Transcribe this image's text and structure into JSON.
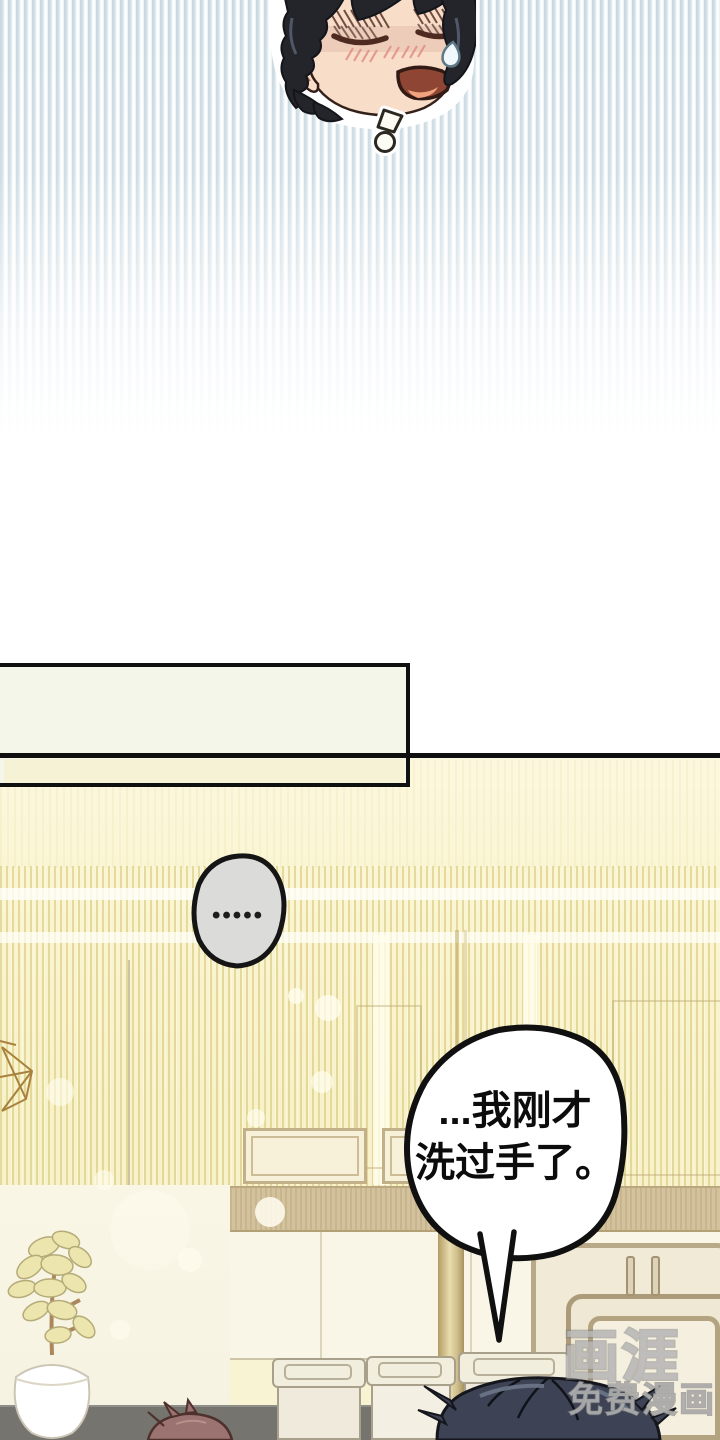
{
  "page": {
    "kind": "webtoon comic page"
  },
  "narration_box": {
    "text": ""
  },
  "thought_bubble": {
    "dots": "•••••"
  },
  "speech_bubble": {
    "line1": "...我刚才",
    "line2": "洗过手了。"
  },
  "watermark": {
    "logo": "画涯",
    "label": "免费漫画"
  },
  "colors": {
    "stripe_blue": "#c7d7e0",
    "panel_yellow": "#f8f3cc",
    "stripe_gold": "#e7d98f",
    "ink": "#111111",
    "thought_grey": "#dbdbd9",
    "speech_white": "#ffffff",
    "hair_black": "#23252b",
    "hair_navy": "#3d4354",
    "hair_mauve": "#9b7370",
    "skin": "#f8ddc9",
    "wood_tan": "#c3ae7f",
    "floor_grey": "#75746e"
  },
  "icons": {
    "sweat_drop_icon": "teardrop",
    "surprise_mark_icon": "!",
    "pendant_lamp_icon": "wireframe-diamond",
    "thought_dots_icon": "•"
  }
}
